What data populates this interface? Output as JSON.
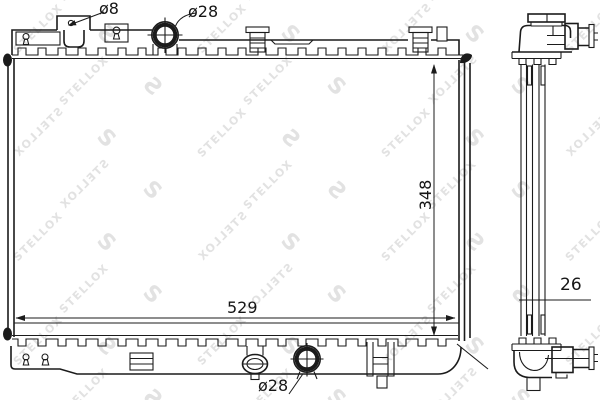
{
  "watermark": {
    "brand": "STELLOX",
    "logo_glyph": "S",
    "color": "#e2e2e2"
  },
  "diagram": {
    "type": "technical line drawing",
    "subject": "automotive radiator, front and side views",
    "line_color": "#1b1b1b",
    "front_view": {
      "dimensions": {
        "mount_hole_diameter": "ø8",
        "top_inlet_diameter": "ø28",
        "height": "348",
        "width": "529",
        "bottom_outlet_diameter": "ø28"
      }
    },
    "side_view": {
      "dimensions": {
        "core_thickness": "26"
      }
    }
  }
}
